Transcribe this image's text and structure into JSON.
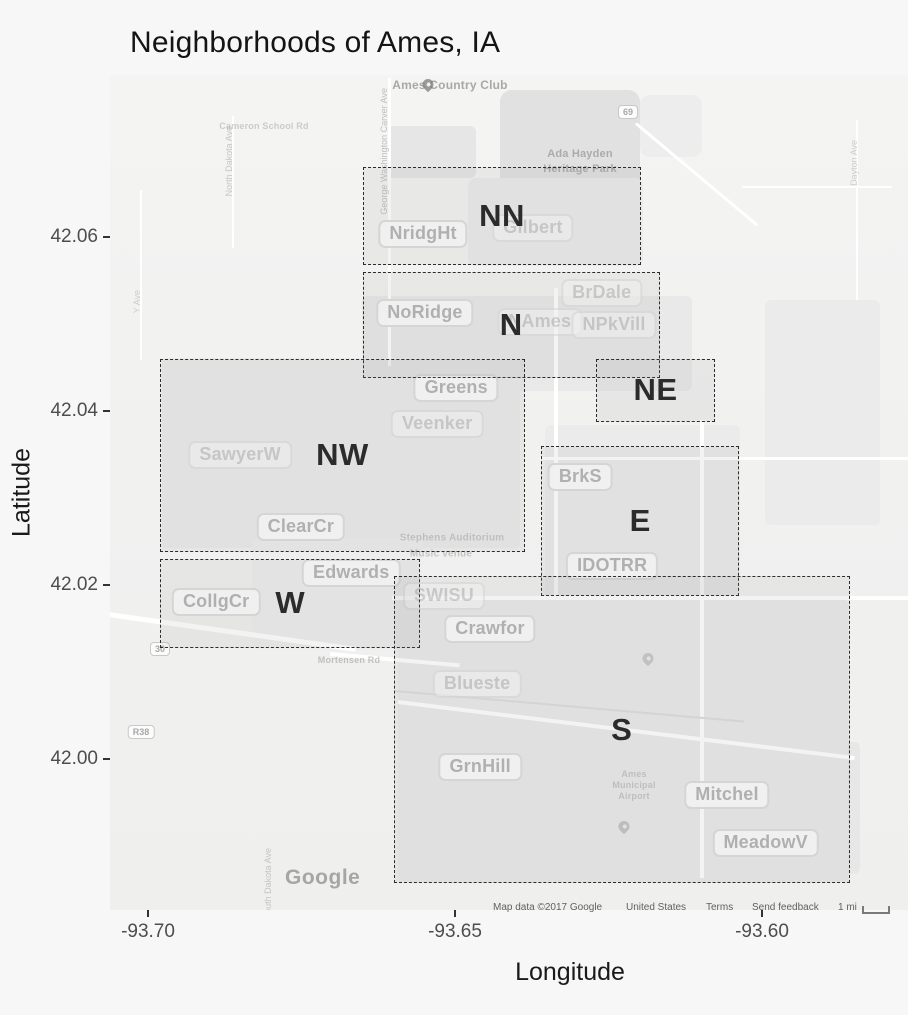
{
  "figure": {
    "title": "Neighborhoods of Ames, IA",
    "x_axis": {
      "label": "Longitude",
      "ticks": [
        {
          "value": -93.7,
          "text": "-93.70"
        },
        {
          "value": -93.65,
          "text": "-93.65"
        },
        {
          "value": -93.6,
          "text": "-93.60"
        }
      ]
    },
    "y_axis": {
      "label": "Latitude",
      "ticks": [
        {
          "value": 42.06,
          "text": "42.06"
        },
        {
          "value": 42.04,
          "text": "42.04"
        },
        {
          "value": 42.02,
          "text": "42.02"
        },
        {
          "value": 42.0,
          "text": "42.00"
        }
      ]
    }
  },
  "chart_data": {
    "type": "map",
    "title": "Neighborhoods of Ames, IA",
    "xlabel": "Longitude",
    "ylabel": "Latitude",
    "xlim": [
      -93.706,
      -93.576
    ],
    "ylim": [
      41.983,
      42.079
    ],
    "regions": [
      {
        "label": "NN",
        "lon_min": -93.665,
        "lon_max": -93.62,
        "lat_min": 42.057,
        "lat_max": 42.068
      },
      {
        "label": "N",
        "lon_min": -93.665,
        "lon_max": -93.617,
        "lat_min": 42.044,
        "lat_max": 42.056
      },
      {
        "label": "NE",
        "lon_min": -93.627,
        "lon_max": -93.608,
        "lat_min": 42.039,
        "lat_max": 42.046
      },
      {
        "label": "NW",
        "lon_min": -93.698,
        "lon_max": -93.639,
        "lat_min": 42.024,
        "lat_max": 42.046
      },
      {
        "label": "W",
        "lon_min": -93.698,
        "lon_max": -93.656,
        "lat_min": 42.013,
        "lat_max": 42.023
      },
      {
        "label": "E",
        "lon_min": -93.636,
        "lon_max": -93.604,
        "lat_min": 42.019,
        "lat_max": 42.036
      },
      {
        "label": "S",
        "lon_min": -93.66,
        "lon_max": -93.586,
        "lat_min": 41.986,
        "lat_max": 42.021
      }
    ],
    "neighborhood_labels": [
      {
        "name": "NridgHt",
        "lon": -93.6552,
        "lat": 42.0603,
        "faint": false
      },
      {
        "name": "Gilbert",
        "lon": -93.6373,
        "lat": 42.061,
        "faint": true
      },
      {
        "name": "NoRidge",
        "lon": -93.6549,
        "lat": 42.0513,
        "faint": false
      },
      {
        "name": "BrDale",
        "lon": -93.6261,
        "lat": 42.0536,
        "faint": true
      },
      {
        "name": "NAmes",
        "lon": -93.6362,
        "lat": 42.0502,
        "faint": true
      },
      {
        "name": "NPkVill",
        "lon": -93.6241,
        "lat": 42.0499,
        "faint": true
      },
      {
        "name": "Greens",
        "lon": -93.6498,
        "lat": 42.0426,
        "faint": false
      },
      {
        "name": "Veenker",
        "lon": -93.6529,
        "lat": 42.0385,
        "faint": true
      },
      {
        "name": "SawyerW",
        "lon": -93.685,
        "lat": 42.0349,
        "faint": true
      },
      {
        "name": "ClearCr",
        "lon": -93.6751,
        "lat": 42.0267,
        "faint": false
      },
      {
        "name": "Edwards",
        "lon": -93.6669,
        "lat": 42.0214,
        "faint": false
      },
      {
        "name": "CollgCr",
        "lon": -93.6889,
        "lat": 42.018,
        "faint": false
      },
      {
        "name": "SWISU",
        "lon": -93.6518,
        "lat": 42.0187,
        "faint": true
      },
      {
        "name": "Crawfor",
        "lon": -93.6443,
        "lat": 42.0149,
        "faint": false
      },
      {
        "name": "Blueste",
        "lon": -93.6464,
        "lat": 42.0086,
        "faint": true
      },
      {
        "name": "BrkS",
        "lon": -93.6296,
        "lat": 42.0324,
        "faint": false
      },
      {
        "name": "IDOTRR",
        "lon": -93.6244,
        "lat": 42.0222,
        "faint": false
      },
      {
        "name": "GrnHill",
        "lon": -93.6459,
        "lat": 41.9991,
        "faint": false
      },
      {
        "name": "Mitchel",
        "lon": -93.6057,
        "lat": 41.9959,
        "faint": false
      },
      {
        "name": "MeadowV",
        "lon": -93.5994,
        "lat": 41.9903,
        "faint": false
      }
    ]
  },
  "map": {
    "watermark": "Google",
    "pois": [
      {
        "text": "Ames Country Club",
        "x": 450,
        "y": 85,
        "size": 12,
        "opacity": 0.75
      },
      {
        "text": "Ada Hayden",
        "x": 580,
        "y": 154,
        "size": 11,
        "opacity": 0.65
      },
      {
        "text": "Heritage Park",
        "x": 580,
        "y": 169,
        "size": 11,
        "opacity": 0.65
      },
      {
        "text": "Stephens Auditorium",
        "x": 452,
        "y": 538,
        "size": 10,
        "opacity": 0.4
      },
      {
        "text": "Music venue",
        "x": 441,
        "y": 554,
        "size": 10,
        "opacity": 0.45
      },
      {
        "text": "Mortensen Rd",
        "x": 349,
        "y": 660,
        "size": 9,
        "opacity": 0.5
      },
      {
        "text": "Cameron School Rd",
        "x": 264,
        "y": 126,
        "size": 9,
        "opacity": 0.4
      },
      {
        "text": "Ames",
        "x": 634,
        "y": 774,
        "size": 9,
        "opacity": 0.4
      },
      {
        "text": "Municipal",
        "x": 634,
        "y": 785,
        "size": 9,
        "opacity": 0.4
      },
      {
        "text": "Airport",
        "x": 634,
        "y": 796,
        "size": 9,
        "opacity": 0.4
      }
    ],
    "street_labels": [
      {
        "text": "George Washington Carver Ave",
        "x": 379,
        "y": 88,
        "opacity": 0.8
      },
      {
        "text": "North Dakota Ave",
        "x": 224,
        "y": 126,
        "opacity": 0.7
      },
      {
        "text": "Y Ave",
        "x": 132,
        "y": 290,
        "opacity": 0.6
      },
      {
        "text": "South Dakota Ave",
        "x": 263,
        "y": 848,
        "opacity": 0.7
      },
      {
        "text": "Dayton Ave",
        "x": 849,
        "y": 140,
        "opacity": 0.6
      }
    ],
    "shields": [
      {
        "text": "69",
        "x": 628,
        "y": 112
      },
      {
        "text": "30",
        "x": 160,
        "y": 649
      },
      {
        "text": "R38",
        "x": 141,
        "y": 732
      }
    ],
    "pins": [
      {
        "x": 428,
        "y": 90,
        "opacity": 0.75
      },
      {
        "x": 648,
        "y": 664,
        "opacity": 0.3
      },
      {
        "x": 624,
        "y": 832,
        "opacity": 0.35
      }
    ],
    "attribution": [
      {
        "text": "Map data ©2017 Google",
        "x": 493,
        "interactable": false
      },
      {
        "text": "United States",
        "x": 626,
        "interactable": false
      },
      {
        "text": "Terms",
        "x": 706,
        "interactable": true
      },
      {
        "text": "Send feedback",
        "x": 752,
        "interactable": true
      },
      {
        "text": "1 mi",
        "x": 838,
        "interactable": false
      }
    ]
  }
}
